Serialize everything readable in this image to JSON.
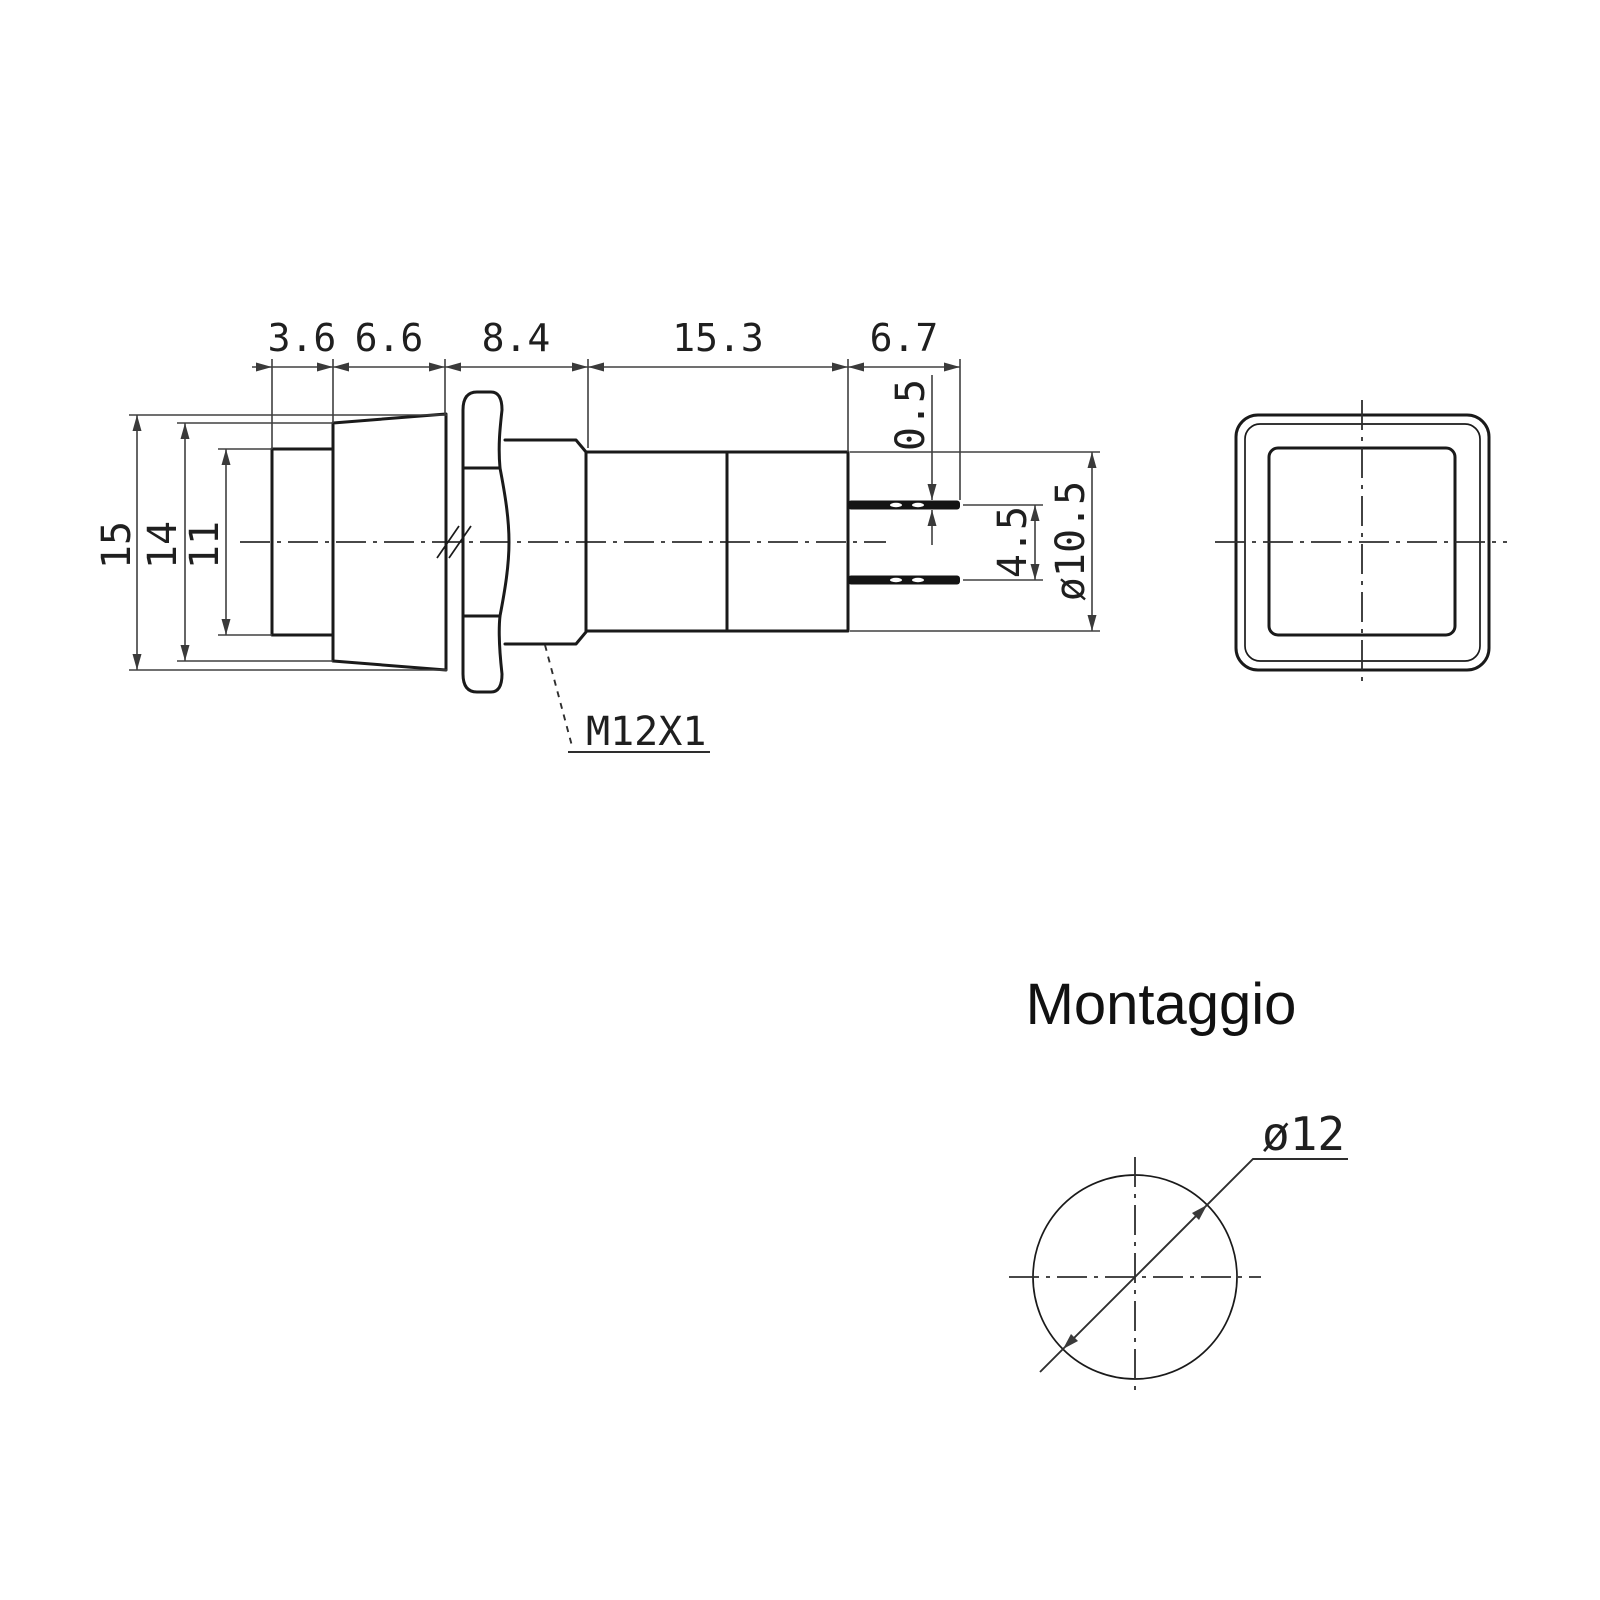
{
  "drawing": {
    "type": "technical-drawing-pushbutton-switch",
    "colors": {
      "background": "#ffffff",
      "shape_line": "#1a1a1a",
      "dimension_line": "#404040",
      "text": "#1f1f1f"
    },
    "side_view": {
      "top_dims": [
        "3.6",
        "6.6",
        "8.4",
        "15.3",
        "6.7"
      ],
      "height_dims": [
        "15",
        "14",
        "11"
      ],
      "pin_thickness": "0.5",
      "pin_spacing": "4.5",
      "body_diameter": "ø10.5",
      "thread": "M12X1"
    },
    "mounting": {
      "title": "Montaggio",
      "hole_diameter": "ø12"
    }
  }
}
